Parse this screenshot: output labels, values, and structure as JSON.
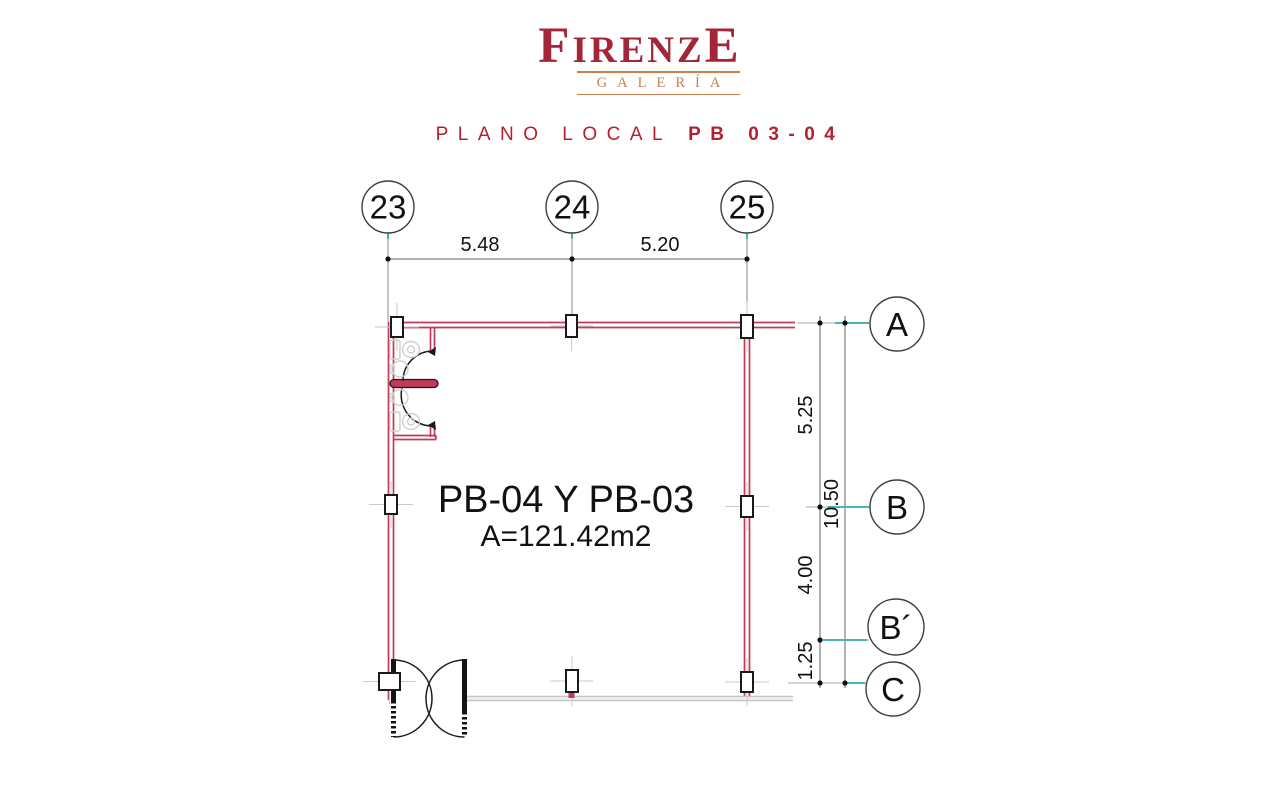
{
  "header": {
    "brand": {
      "first": "F",
      "mid": "IRENZ",
      "last": "E",
      "sub": "GALERÍA"
    },
    "title": {
      "regular": "PLANO LOCAL",
      "bold": "PB 03-04"
    }
  },
  "colors": {
    "brand_red": "#A32638",
    "brand_tan": "#C8814F",
    "title_red": "#B5202F",
    "wall_red": "#C23A5A",
    "wall_gray": "#C6C6C6",
    "axis_teal": "#49B6B6"
  },
  "plan": {
    "room": {
      "label": "PB-04 Y PB-03",
      "area": "A=121.42m2"
    },
    "top_axes": [
      {
        "id": "23"
      },
      {
        "id": "24"
      },
      {
        "id": "25"
      }
    ],
    "top_dims": [
      {
        "value": "5.48"
      },
      {
        "value": "5.20"
      }
    ],
    "side_axes": [
      {
        "id": "A"
      },
      {
        "id": "B"
      },
      {
        "id": "B´"
      },
      {
        "id": "C"
      }
    ],
    "side_dims": [
      {
        "value": "5.25"
      },
      {
        "value": "10.50"
      },
      {
        "value": "4.00"
      },
      {
        "value": "1.25"
      }
    ]
  }
}
